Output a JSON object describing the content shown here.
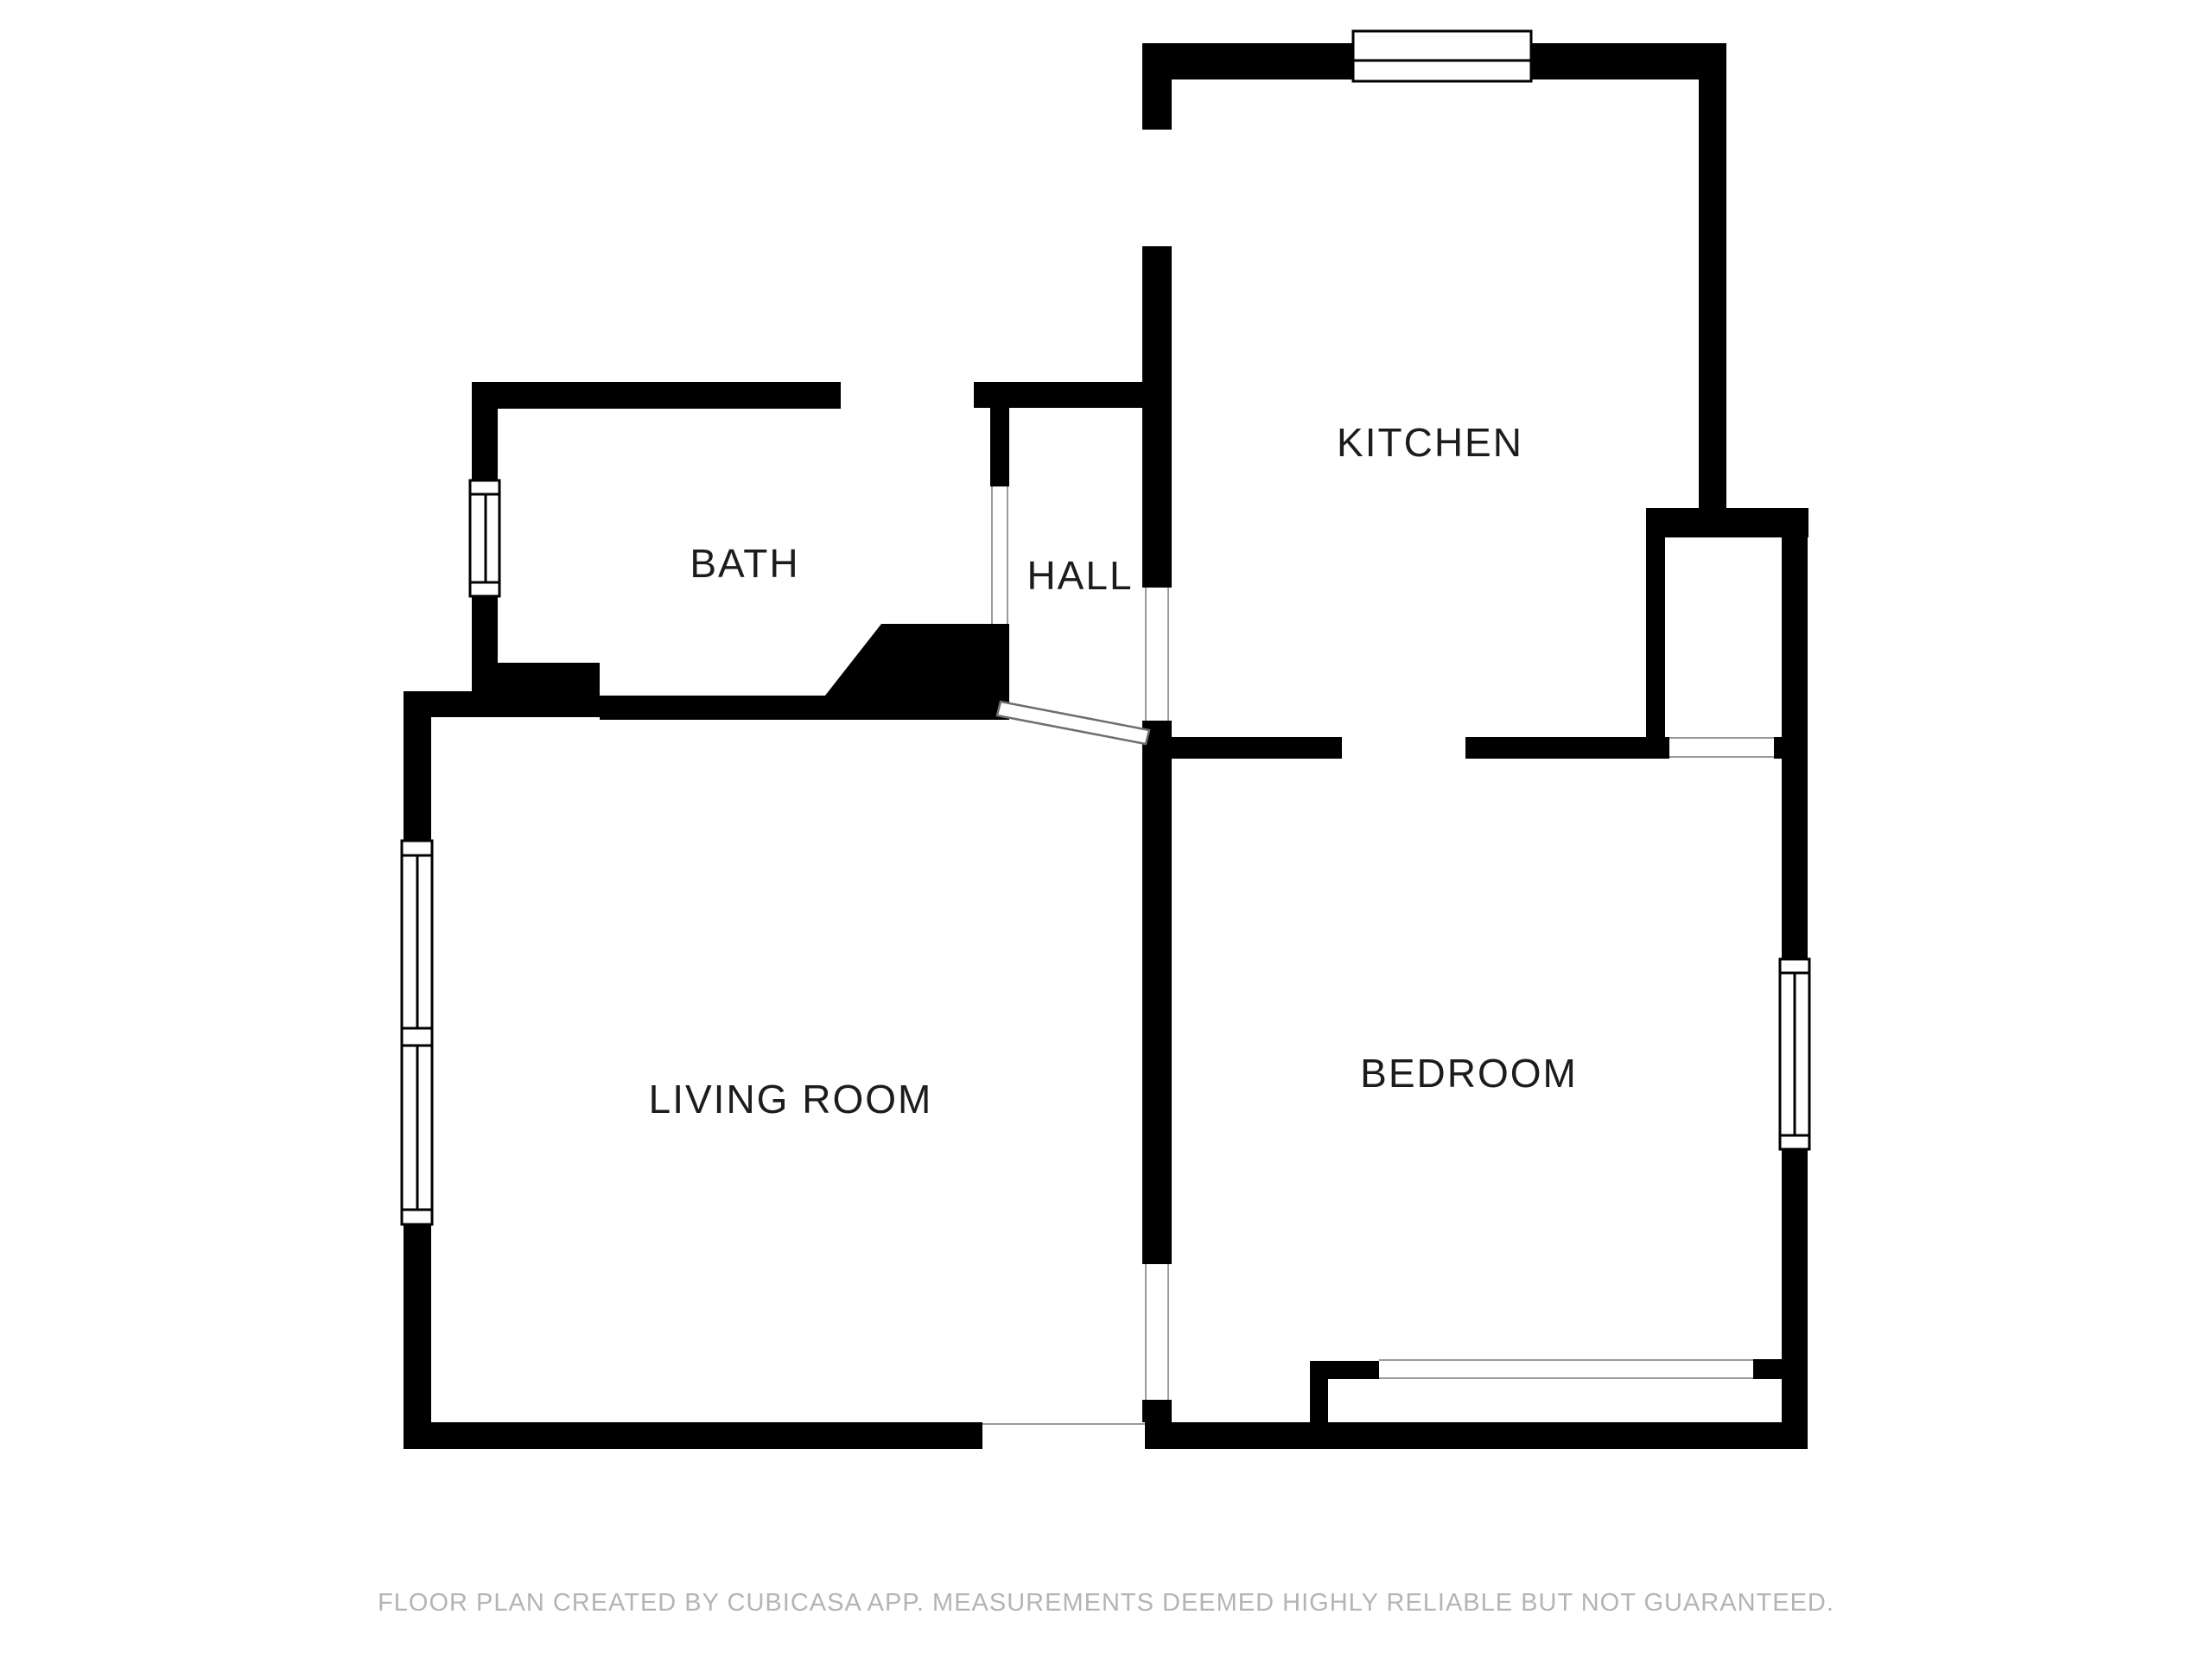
{
  "floor_plan": {
    "rooms": [
      {
        "name": "KITCHEN"
      },
      {
        "name": "BATH"
      },
      {
        "name": "HALL"
      },
      {
        "name": "LIVING ROOM"
      },
      {
        "name": "BEDROOM"
      }
    ],
    "footer": "FLOOR PLAN CREATED BY CUBICASA APP. MEASUREMENTS DEEMED HIGHLY RELIABLE BUT NOT GUARANTEED.",
    "colors": {
      "wall": "#000000",
      "background": "#ffffff",
      "label": "#1c1c1c",
      "footer": "#b4b4b4",
      "opening_line": "#9a9a9a",
      "door_line": "#6f6f6f"
    }
  }
}
